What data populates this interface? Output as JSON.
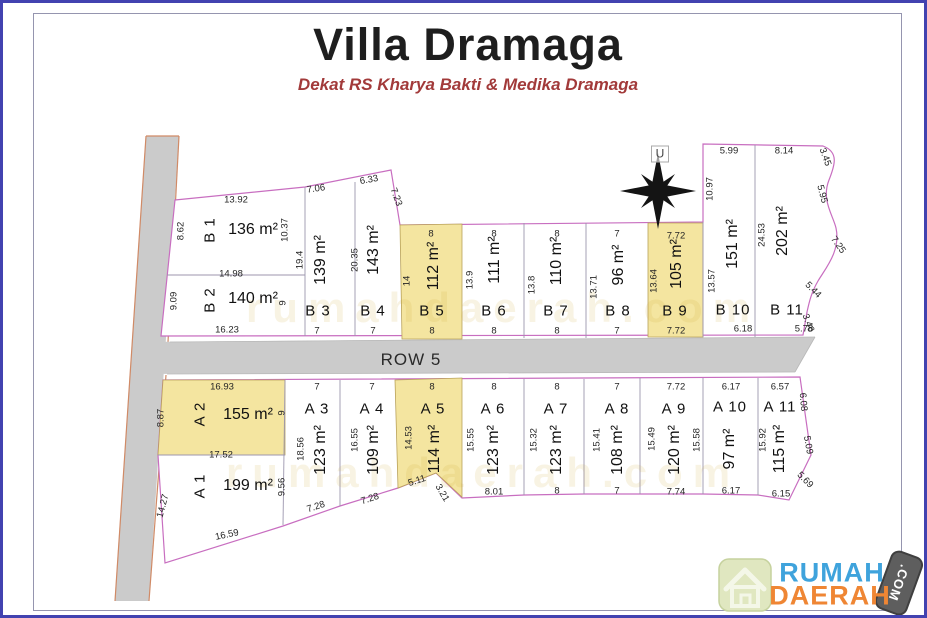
{
  "title": "Villa Dramaga",
  "subtitle": "Dekat RS Kharya Bakti & Medika Dramaga",
  "compass_label": "U",
  "road_label": "ROW 5",
  "watermark": "rumahdaerah.com",
  "logo": {
    "line1": "RUMAH",
    "line2": "DAERAH",
    "badge": ".COM"
  },
  "colors": {
    "boundary_pink": "#c86ec0",
    "divider_gray": "#9c96ae",
    "road_gray": "#cbcbcb",
    "highlight_yellow": "#f4e5a0",
    "logo_blue": "#3fa3dc",
    "logo_orange": "#ef8634",
    "subtitle_red": "#a23a3a"
  },
  "lots": [
    {
      "id": "B 1",
      "area": "136 m²",
      "highlight": false,
      "dims": {
        "top": "13.92",
        "left": "8.62",
        "right": "10.37"
      }
    },
    {
      "id": "B 2",
      "area": "140 m²",
      "highlight": false,
      "dims": {
        "top": "14.98",
        "left": "9.09",
        "right": "9",
        "bottom": "16.23"
      }
    },
    {
      "id": "B 3",
      "area": "139 m²",
      "highlight": false,
      "dims": {
        "top": "7.06",
        "left": "19.4",
        "bottom": "7"
      }
    },
    {
      "id": "B 4",
      "area": "143 m²",
      "highlight": false,
      "dims": {
        "top": "6.33",
        "left": "20.35",
        "bottom": "7",
        "diag": "7.23"
      }
    },
    {
      "id": "B 5",
      "area": "112 m²",
      "highlight": true,
      "dims": {
        "top": "8",
        "left": "14",
        "bottom": "8"
      }
    },
    {
      "id": "B 6",
      "area": "111 m²",
      "highlight": false,
      "dims": {
        "top": "8",
        "left": "13.9",
        "bottom": "8"
      }
    },
    {
      "id": "B 7",
      "area": "110 m²",
      "highlight": false,
      "dims": {
        "top": "8",
        "left": "13.8",
        "bottom": "8"
      }
    },
    {
      "id": "B 8",
      "area": "96 m²",
      "highlight": false,
      "dims": {
        "top": "7",
        "left": "13.71",
        "bottom": "7"
      }
    },
    {
      "id": "B 9",
      "area": "105 m²",
      "highlight": true,
      "dims": {
        "top": "7.72",
        "left": "13.64",
        "bottom": "7.72"
      }
    },
    {
      "id": "B 10",
      "area": "151 m²",
      "highlight": false,
      "dims": {
        "top": "5.99",
        "left_upper": "10.97",
        "left": "13.57",
        "bottom": "6.18"
      }
    },
    {
      "id": "B 11",
      "area": "202 m²",
      "highlight": false,
      "dims": {
        "top": "8.14",
        "left": "24.53",
        "bottom": "5.78"
      },
      "right_dims": [
        "3.45",
        "5.95",
        "7.25",
        "5.44",
        "3.46"
      ]
    },
    {
      "id": "A 2",
      "area": "155 m²",
      "highlight": true,
      "dims": {
        "top": "16.93",
        "left": "8.87",
        "right": "9",
        "bottom": "17.52"
      }
    },
    {
      "id": "A 1",
      "area": "199 m²",
      "highlight": false,
      "dims": {
        "left": "14.27",
        "right": "9.56",
        "bottom": "16.59"
      }
    },
    {
      "id": "A 3",
      "area": "123 m²",
      "highlight": false,
      "dims": {
        "top": "7",
        "left": "18.56",
        "bottom": "7.28"
      }
    },
    {
      "id": "A 4",
      "area": "109 m²",
      "highlight": false,
      "dims": {
        "top": "7",
        "left": "16.55",
        "bottom": "7.28"
      }
    },
    {
      "id": "A 5",
      "area": "114 m²",
      "highlight": true,
      "dims": {
        "top": "8",
        "left": "14.53",
        "bottom": "5.11",
        "diag": "3.21"
      }
    },
    {
      "id": "A 6",
      "area": "123 m²",
      "highlight": false,
      "dims": {
        "top": "8",
        "left": "15.55",
        "bottom": "8.01"
      }
    },
    {
      "id": "A 7",
      "area": "123 m²",
      "highlight": false,
      "dims": {
        "top": "8",
        "left": "15.32",
        "bottom": "8"
      }
    },
    {
      "id": "A 8",
      "area": "108 m²",
      "highlight": false,
      "dims": {
        "top": "7",
        "left": "15.41",
        "bottom": "7"
      }
    },
    {
      "id": "A 9",
      "area": "120 m²",
      "highlight": false,
      "dims": {
        "top": "7.72",
        "left": "15.49",
        "right": "15.58",
        "bottom": "7.74"
      }
    },
    {
      "id": "A 10",
      "area": "97 m²",
      "highlight": false,
      "dims": {
        "top": "6.17",
        "bottom": "6.17"
      }
    },
    {
      "id": "A 11",
      "area": "115 m²",
      "highlight": false,
      "dims": {
        "top": "6.57",
        "left": "15.92",
        "bottom": "6.15"
      },
      "right_dims": [
        "6.08",
        "5.09",
        "5.69"
      ]
    }
  ]
}
